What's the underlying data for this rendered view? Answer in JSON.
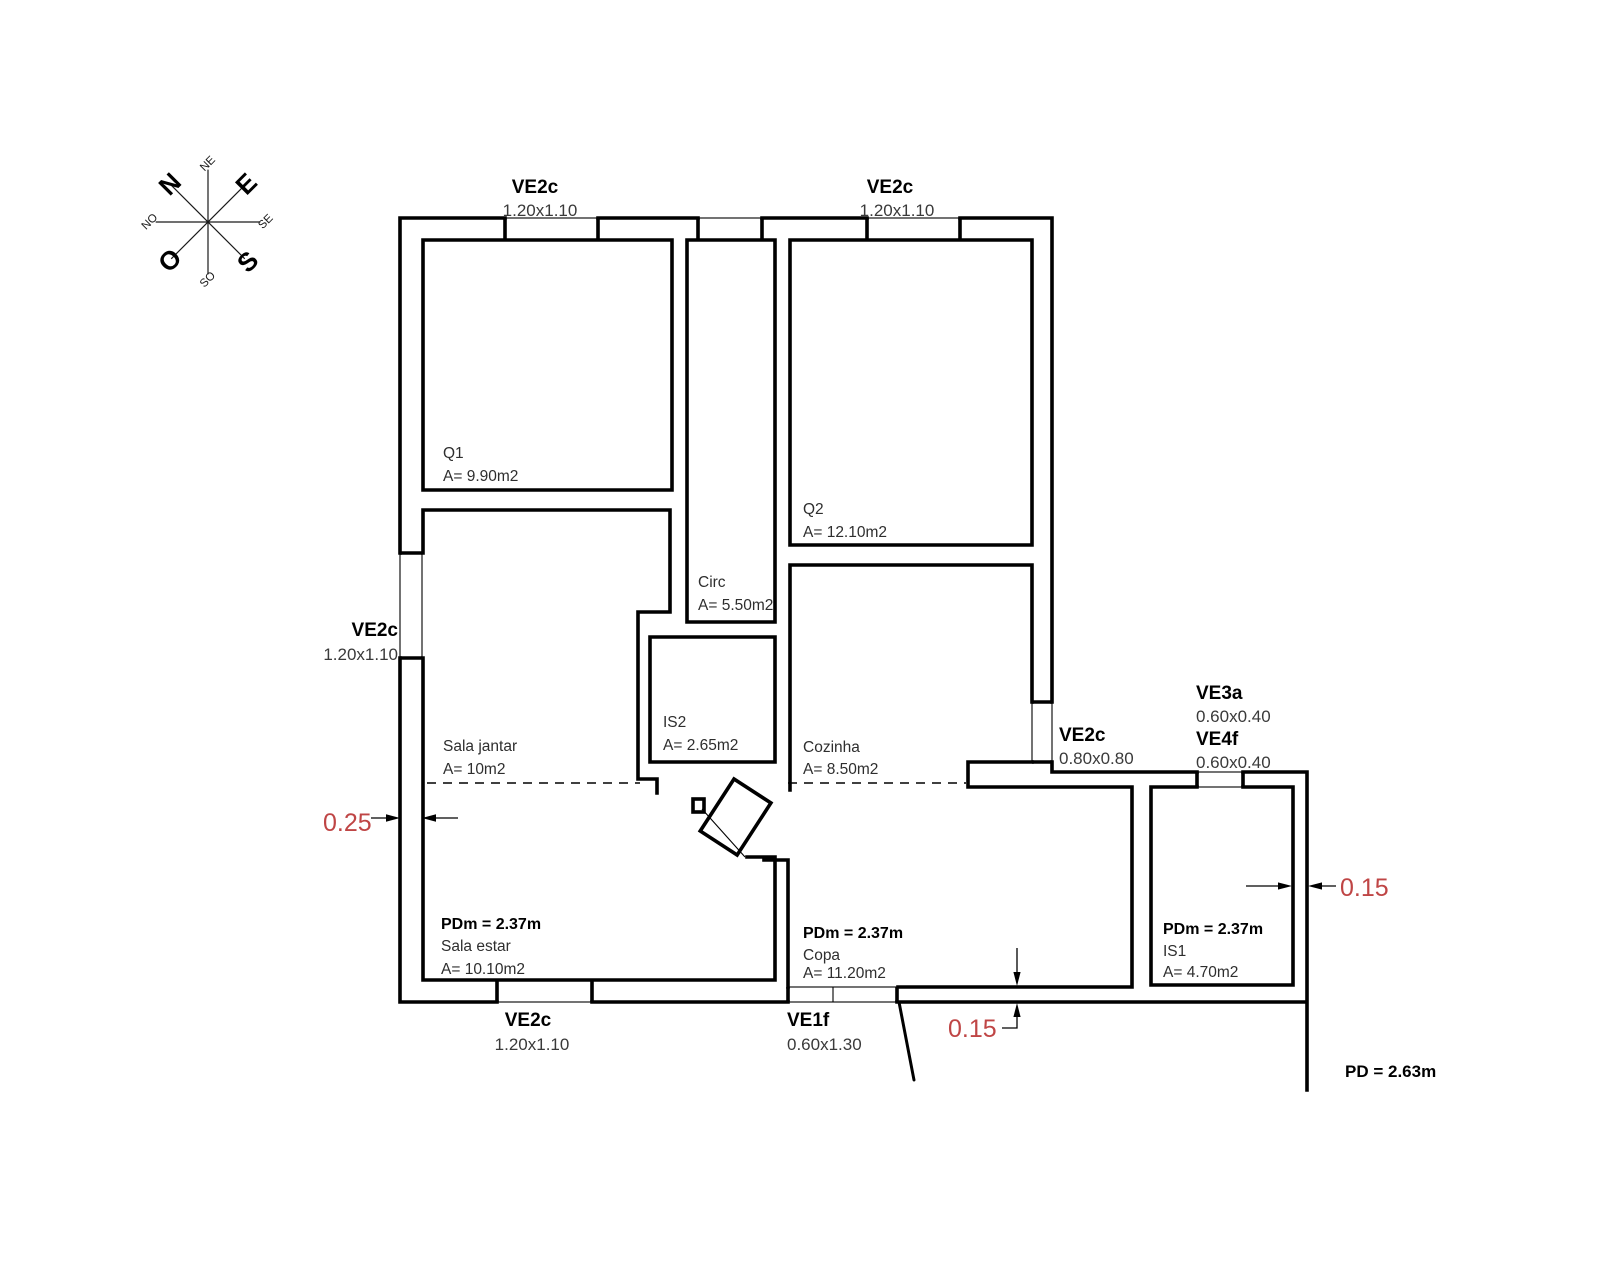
{
  "drawing": {
    "background": "#ffffff",
    "line_color": "#000000",
    "text_color": "#2e2e2e",
    "dimension_red": "#bf4545"
  },
  "compass": {
    "n": "N",
    "e": "E",
    "s": "S",
    "o": "O",
    "ne": "NE",
    "se": "SE",
    "so": "SO",
    "no": "NO"
  },
  "windows": {
    "top_left": {
      "code": "VE2c",
      "size": "1.20x1.10"
    },
    "top_right": {
      "code": "VE2c",
      "size": "1.20x1.10"
    },
    "left": {
      "code": "VE2c",
      "size": "1.20x1.10"
    },
    "bottom": {
      "code": "VE2c",
      "size": "1.20x1.10"
    },
    "entry": {
      "code": "VE1f",
      "size": "0.60x1.30"
    },
    "east": {
      "code": "VE2c",
      "size": "0.80x0.80"
    },
    "ve3a": {
      "code": "VE3a",
      "size": "0.60x0.40"
    },
    "ve4f": {
      "code": "VE4f",
      "size": "0.60x0.40"
    }
  },
  "rooms": {
    "q1": {
      "name": "Q1",
      "area": "A= 9.90m2"
    },
    "q2": {
      "name": "Q2",
      "area": "A= 12.10m2"
    },
    "circ": {
      "name": "Circ",
      "area": "A= 5.50m2"
    },
    "is2": {
      "name": "IS2",
      "area": "A= 2.65m2"
    },
    "sala_jantar": {
      "name": "Sala jantar",
      "area": "A= 10m2"
    },
    "cozinha": {
      "name": "Cozinha",
      "area": "A= 8.50m2"
    },
    "sala_estar": {
      "name": "Sala estar",
      "area": "A= 10.10m2",
      "ceiling": "PDm = 2.37m"
    },
    "copa": {
      "name": "Copa",
      "area": "A= 11.20m2",
      "ceiling": "PDm = 2.37m"
    },
    "is1": {
      "name": "IS1",
      "area": "A= 4.70m2",
      "ceiling": "PDm = 2.37m"
    }
  },
  "dimensions": {
    "left_wall": "0.25",
    "bottom_wall": "0.15",
    "right_wall": "0.15"
  },
  "notes": {
    "ceiling_total": "PD = 2.63m"
  }
}
